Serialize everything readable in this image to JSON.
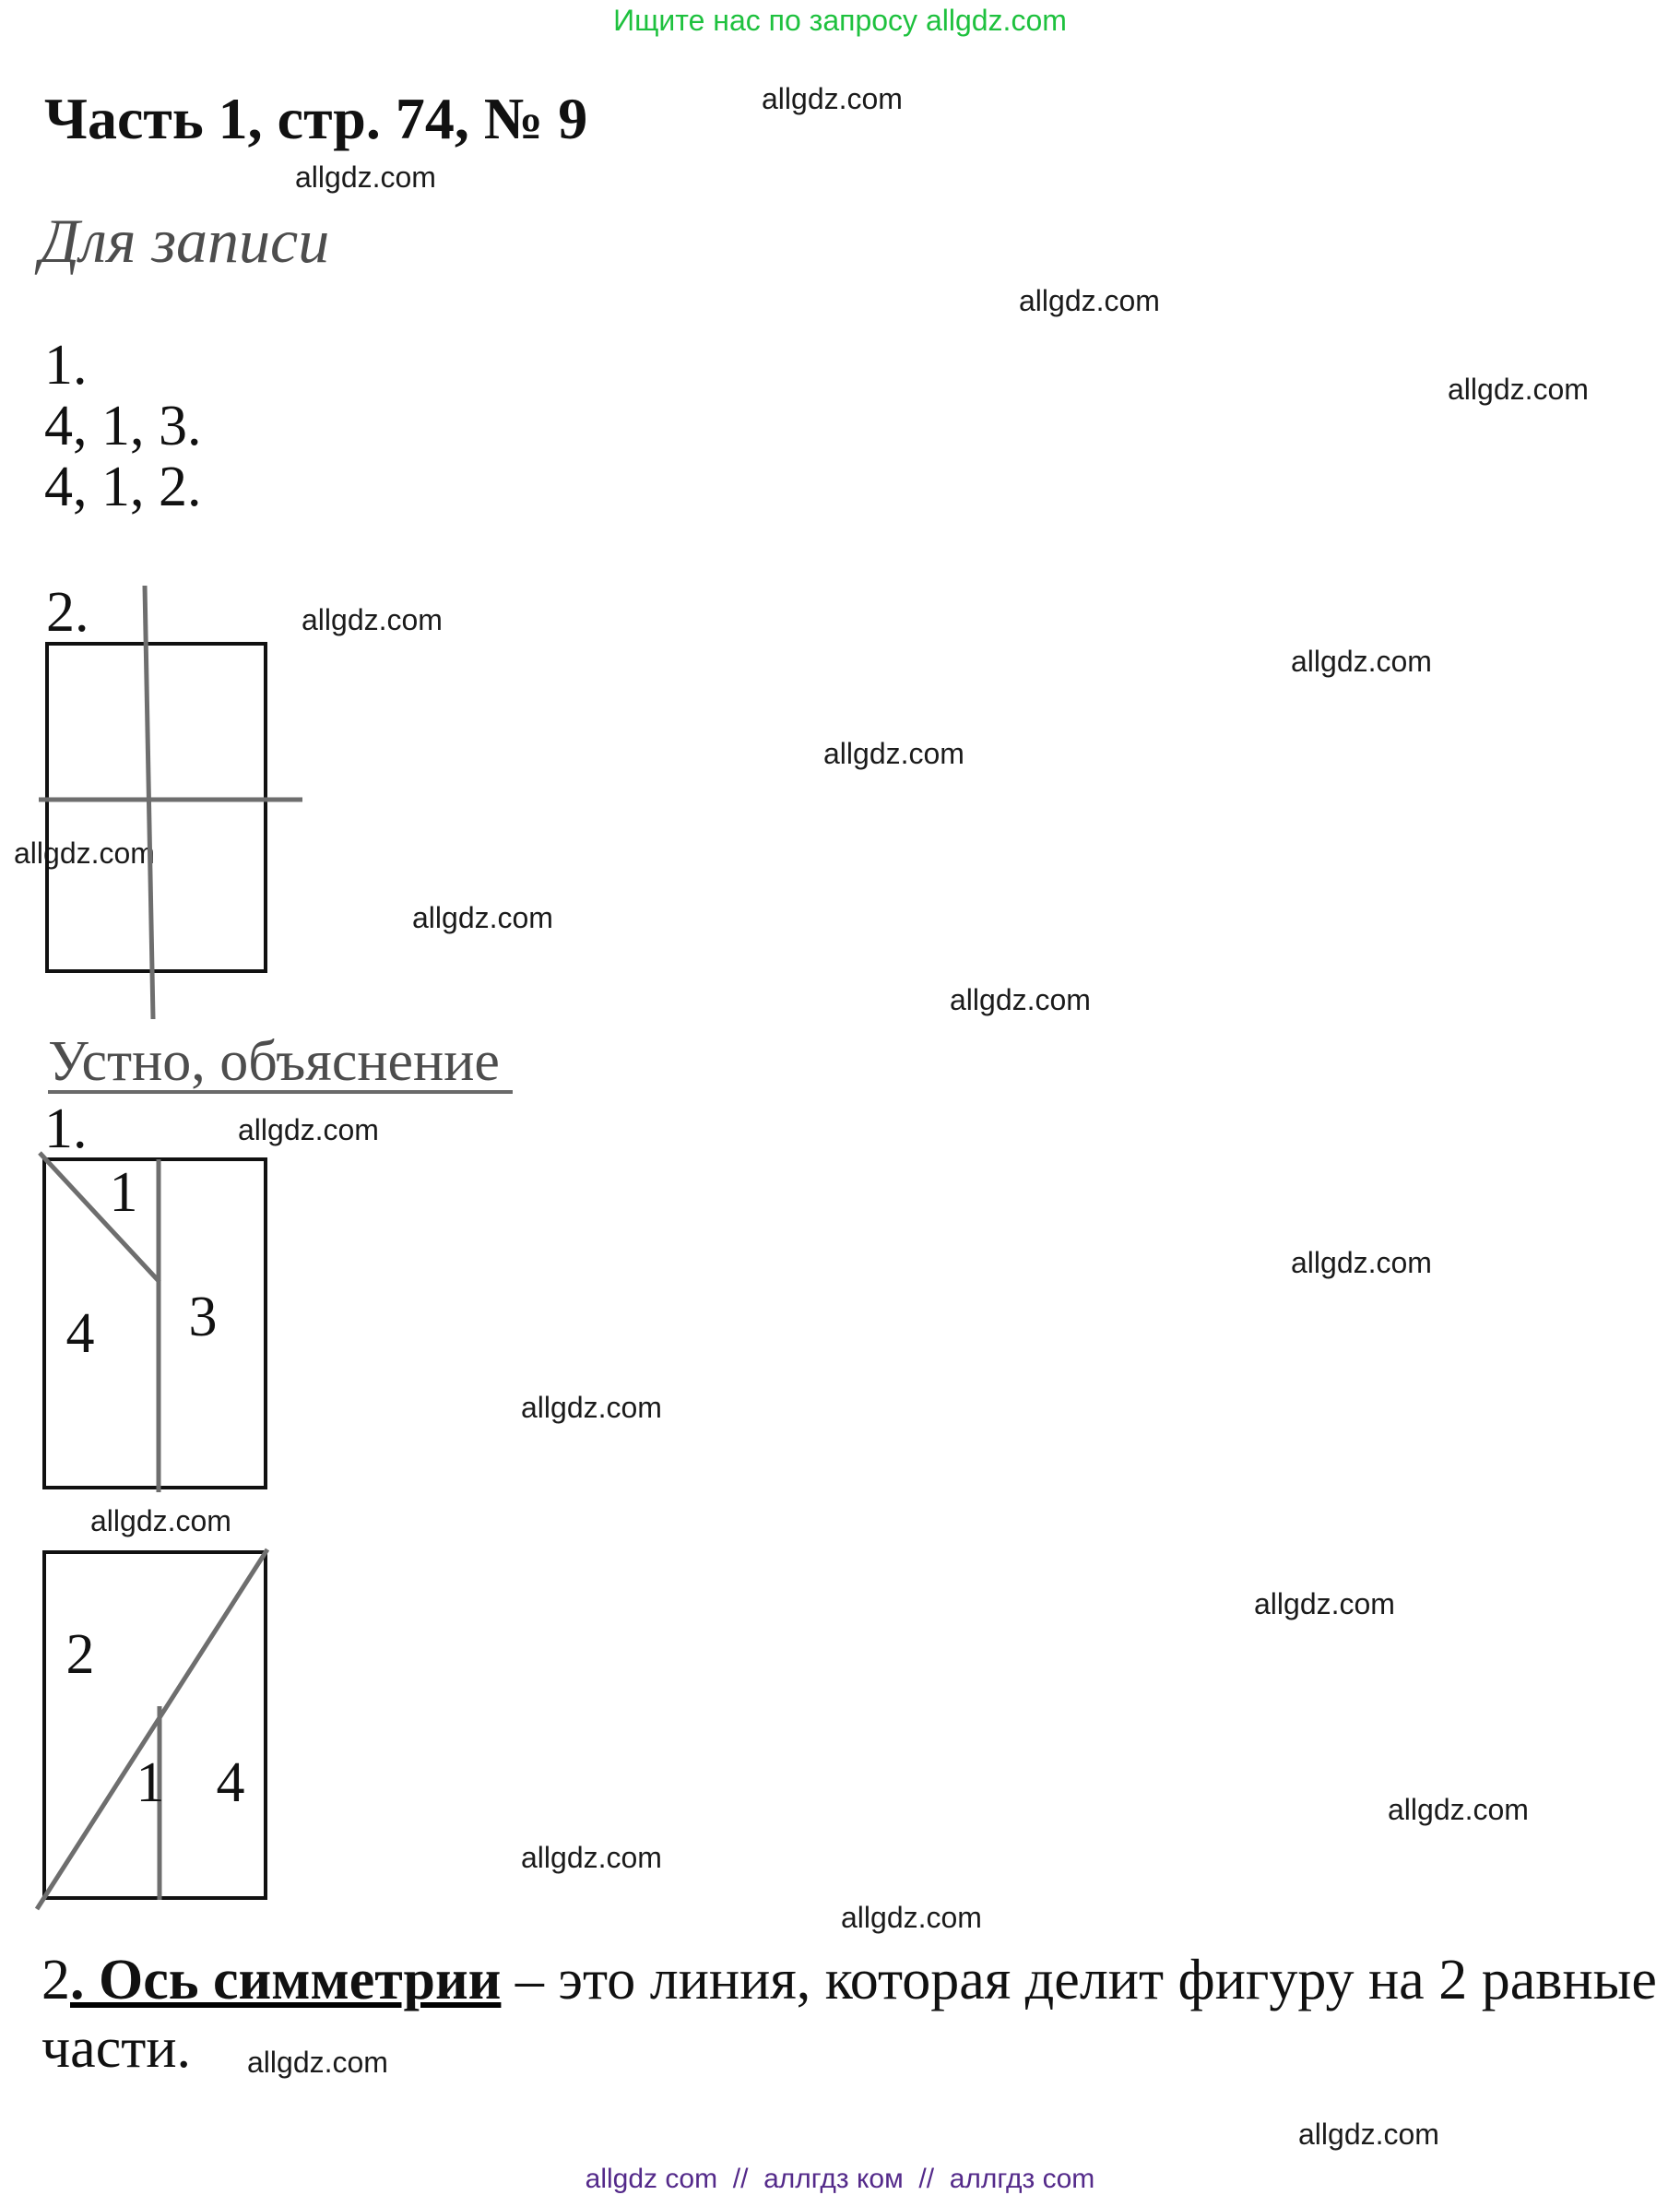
{
  "page": {
    "header_green": "Ищите нас по запросу allgdz.com",
    "title": "Часть 1, стр. 74, № 9",
    "watermark": "allgdz.com",
    "section1_heading": "Для записи",
    "section1_items": [
      "1.",
      "4, 1, 3.",
      "4, 1, 2."
    ],
    "figure1_label": "2.",
    "section2_heading": "Устно, объяснение",
    "section2_item": "1.",
    "figure2_labels": {
      "top": "1",
      "left": "4",
      "right": "3"
    },
    "figure3_labels": {
      "left": "2",
      "mid": "1",
      "right": "4"
    },
    "definition": {
      "num": "2",
      "term": ". Ось симметрии",
      "rest_line1": " – это линия, которая делит фигуру на 2 равные",
      "line2": "части."
    },
    "footer": "allgdz com  //  аллгдз ком  //  аллгдз com",
    "colors": {
      "promo_green": "#1ec13e",
      "footer_purple": "#542a8a",
      "heading_gray": "#4d4d4d",
      "figure_line_gray": "#6e6e6e"
    }
  }
}
